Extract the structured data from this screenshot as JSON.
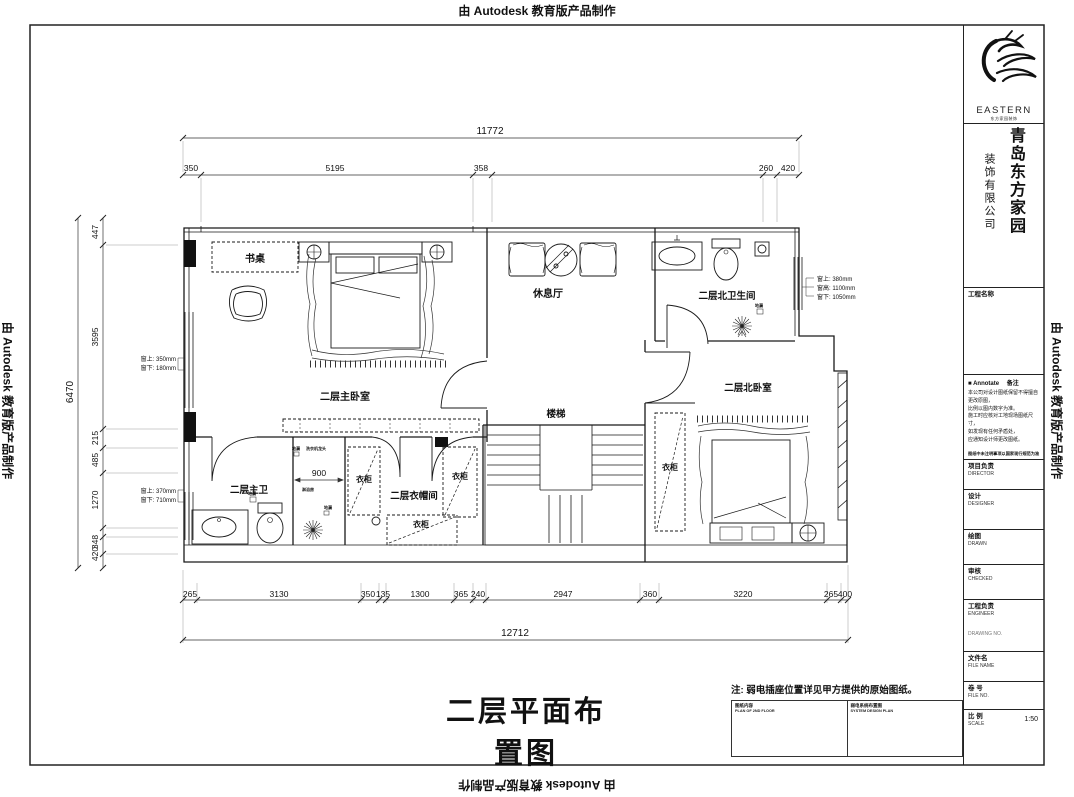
{
  "watermark": "由 Autodesk 教育版产品制作",
  "sheet": {
    "title": "二层平面布置图",
    "note": "注: 弱电插座位置详见甲方提供的原始图纸。",
    "footer_table": {
      "left_cn": "图纸内容",
      "left_en": "PLAN OF 2ND FLOOR",
      "right_cn": "弱电系统布置图",
      "right_en": "SYSTEM DESIGN PLAN"
    }
  },
  "title_block": {
    "brand": "EASTERN",
    "brand_sub": "东方家园装饰",
    "company_col_main": "青岛东方家园",
    "company_col_sub": "装饰有限公司",
    "project_name_label": "工程名称",
    "annotate": {
      "bullet": "■",
      "label": "Annotate",
      "suffix": "备注"
    },
    "notice_lines": [
      "本公司对设计图纸保留不得擅自更改原图，",
      "比例以图内数字为准。",
      "施工时应核对工地现场图纸尺寸，",
      "如发现有任何矛盾处，",
      "应通知设计师更改图纸。"
    ],
    "notice_footer": "图纸中未注明事项以国家现行规范为准",
    "fields": [
      {
        "cn": "项目负责",
        "en": "DIRECTOR"
      },
      {
        "cn": "设计",
        "en": "DESIGNER"
      },
      {
        "cn": "绘图",
        "en": "DRAWN"
      },
      {
        "cn": "审核",
        "en": "CHECKED"
      },
      {
        "cn": "工程负责",
        "en": "ENGINEER"
      }
    ],
    "drawing_no_label": "DRAWING NO.",
    "file_name": {
      "cn": "文件名",
      "en": "FILE NAME"
    },
    "file_no": {
      "cn": "卷  号",
      "en": "FILE NO."
    },
    "scale": {
      "cn": "比  例",
      "en": "SCALE",
      "value": "1:50"
    }
  },
  "plan": {
    "rooms": {
      "master_bedroom": "二层主卧室",
      "lounge": "休息厅",
      "stairs": "楼梯",
      "north_bath": "二层北卫生间",
      "north_bedroom": "二层北卧室",
      "master_bath": "二层主卫",
      "closet": "二层衣帽间",
      "desk": "书桌",
      "wardrobe": "衣柜"
    },
    "fixtures": {
      "floor_drain": "地漏",
      "washer_tap": "洗衣机龙头",
      "shower_room": "淋浴房"
    },
    "shower_width": "900",
    "win_left_1": [
      "窗上: 350mm",
      "窗下: 180mm"
    ],
    "win_left_2": [
      "窗上: 370mm",
      "窗下: 710mm"
    ],
    "win_right": [
      "窗上: 380mm",
      "窗高: 1100mm",
      "窗下: 1050mm"
    ],
    "dims": {
      "top_total": "11772",
      "top": [
        "350",
        "5195",
        "358",
        "260",
        "420"
      ],
      "left_total": "6470",
      "left": [
        "447",
        "3595",
        "215",
        "485",
        "1270",
        "348",
        "420"
      ],
      "bottom": [
        "265",
        "3130",
        "350",
        "135",
        "1300",
        "365",
        "240",
        "2947",
        "360",
        "3220",
        "265",
        "400"
      ],
      "bottom_total": "12712"
    }
  }
}
